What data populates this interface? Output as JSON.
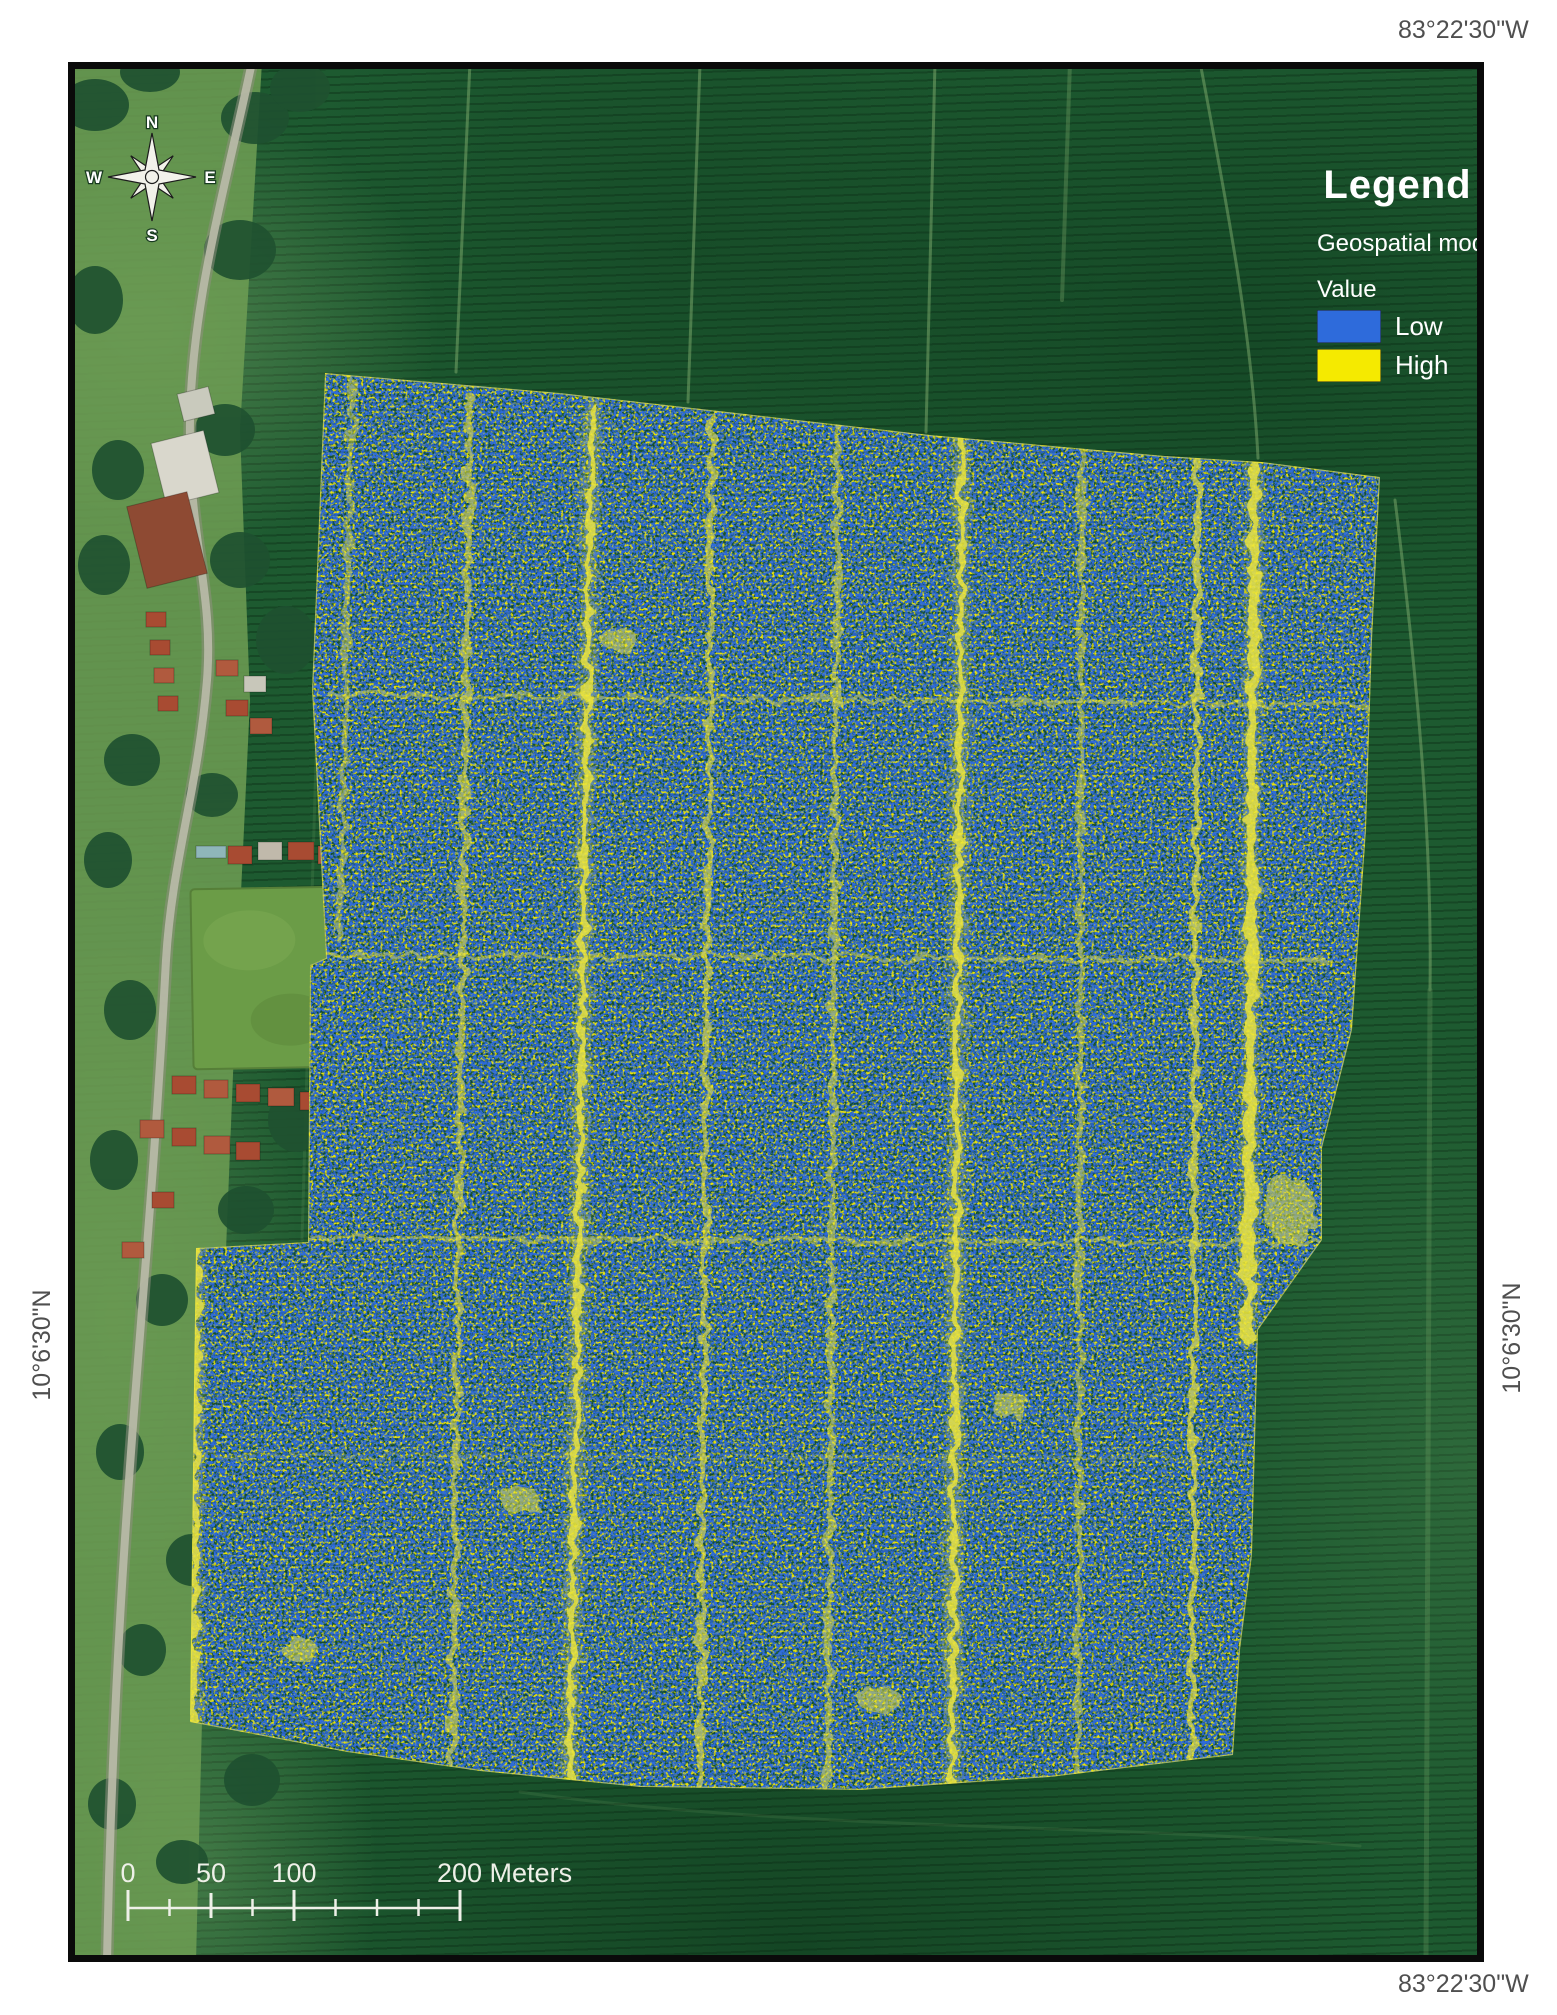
{
  "figure": {
    "coordinate_labels": {
      "top_right": "83°22'30\"W",
      "bottom_right": "83°22'30\"W",
      "left": "10°6'30\"N",
      "right": "10°6'30\"N"
    },
    "compass": {
      "north": "N",
      "east": "E",
      "south": "S",
      "west": "W"
    },
    "legend": {
      "title": "Legend",
      "layer": "Geospatial model",
      "field": "Value",
      "items": [
        {
          "label": "Low",
          "color": "#2e6bdb"
        },
        {
          "label": "High",
          "color": "#f5ea00"
        }
      ]
    },
    "scale_bar": {
      "labels": [
        "0",
        "50",
        "100",
        "200 Meters"
      ]
    },
    "attribution": {
      "line1": "Sources: Esri, DigitalGlobe, GeoEye, Earthstar Geographics, CNES/Airbus",
      "line2": "DS, USDA, USGS, AeroGRID, IGN, and the GIS User Community"
    }
  }
}
